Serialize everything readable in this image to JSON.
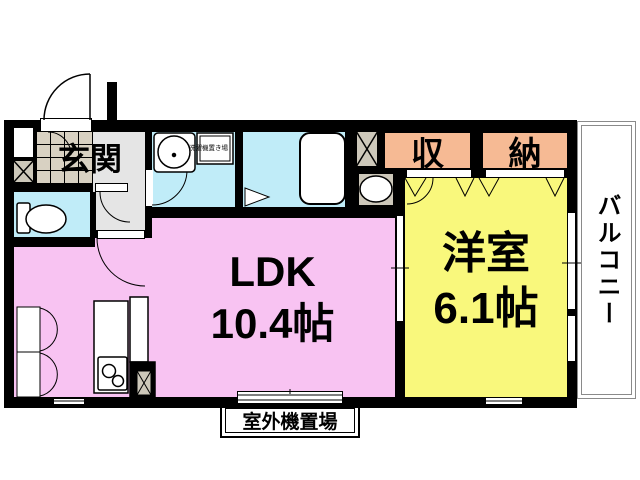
{
  "floorplan": {
    "rooms": {
      "entrance": {
        "label": "玄関"
      },
      "ldk": {
        "label": "LDK",
        "size": "10.4帖"
      },
      "western_room": {
        "label": "洋室",
        "size": "6.1帖"
      },
      "storage": {
        "label_left": "収",
        "label_right": "納"
      },
      "balcony": {
        "label": "バルコニー"
      },
      "washer_space": {
        "label": "洗濯機置き場"
      },
      "outdoor_unit": {
        "label": "室外機置場"
      }
    },
    "colors": {
      "wall": "#000000",
      "ldk_pink": "#f8c3f2",
      "western_yellow": "#f9f87c",
      "wet_cyan": "#c0ecf8",
      "storage_salmon": "#f6ba94",
      "tile_beige": "#d8d1c2",
      "hall_gray": "#e5e5e5",
      "ps_beige": "#cdc8ba",
      "balcony_border": "#8a8a8a"
    }
  }
}
